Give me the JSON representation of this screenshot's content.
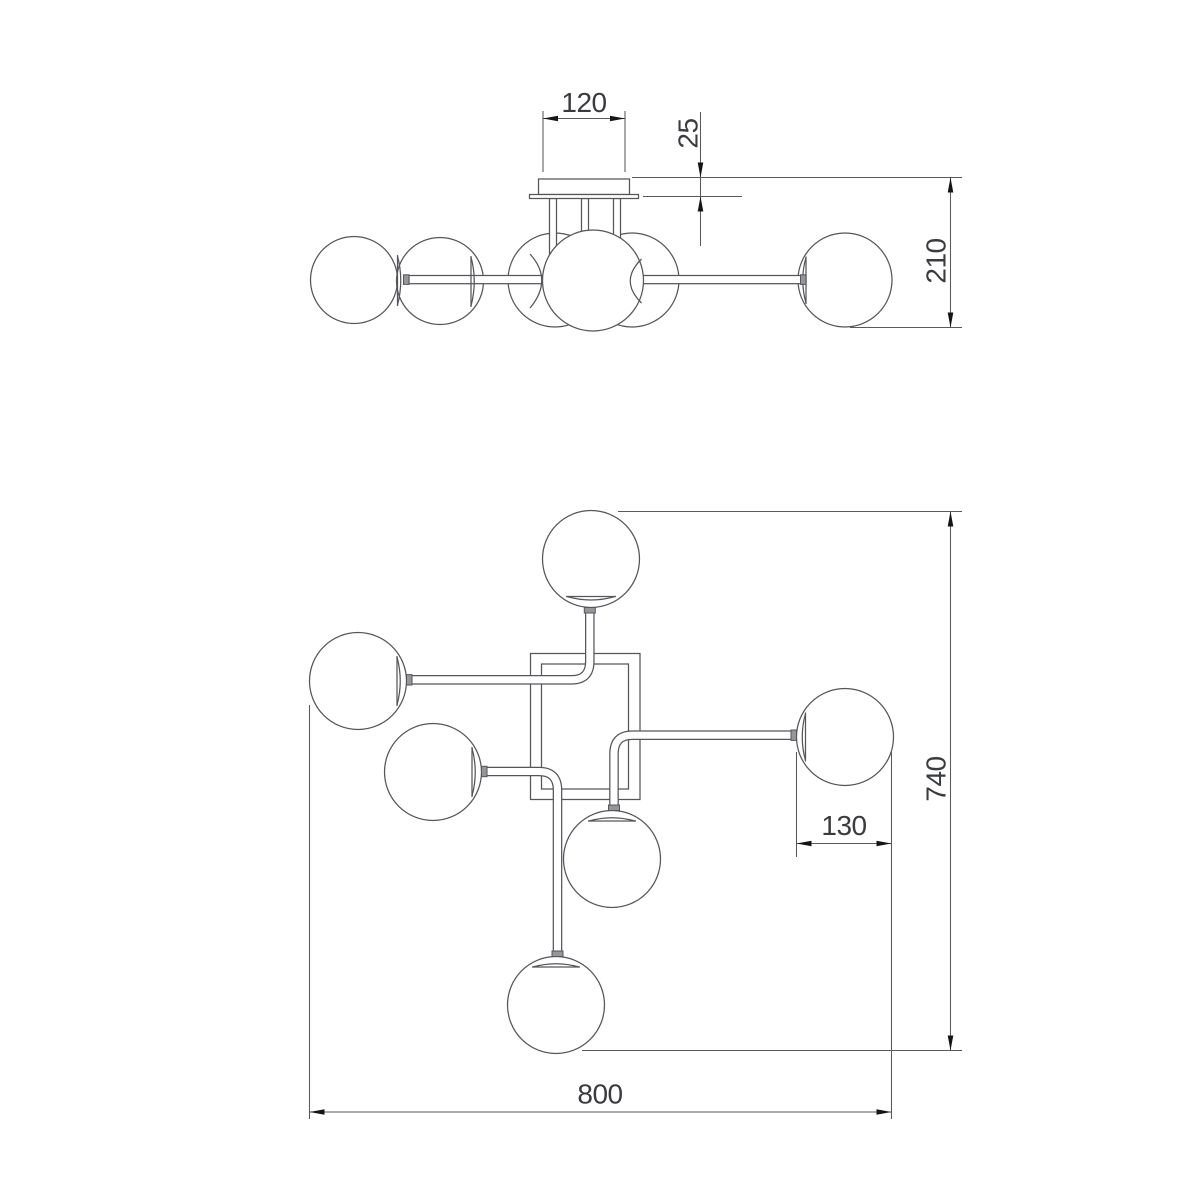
{
  "drawing": {
    "type": "luminaire-dimension-drawing",
    "colors": {
      "line": "#55565a",
      "dim": "#595a5e",
      "arrow": "#151515",
      "text": "#3a3b3e",
      "bg": "#ffffff"
    },
    "dimensions": {
      "canopy_width": "120",
      "canopy_height": "25",
      "overall_height": "210",
      "shade_diameter": "130",
      "overall_depth": "740",
      "overall_width": "800"
    }
  }
}
